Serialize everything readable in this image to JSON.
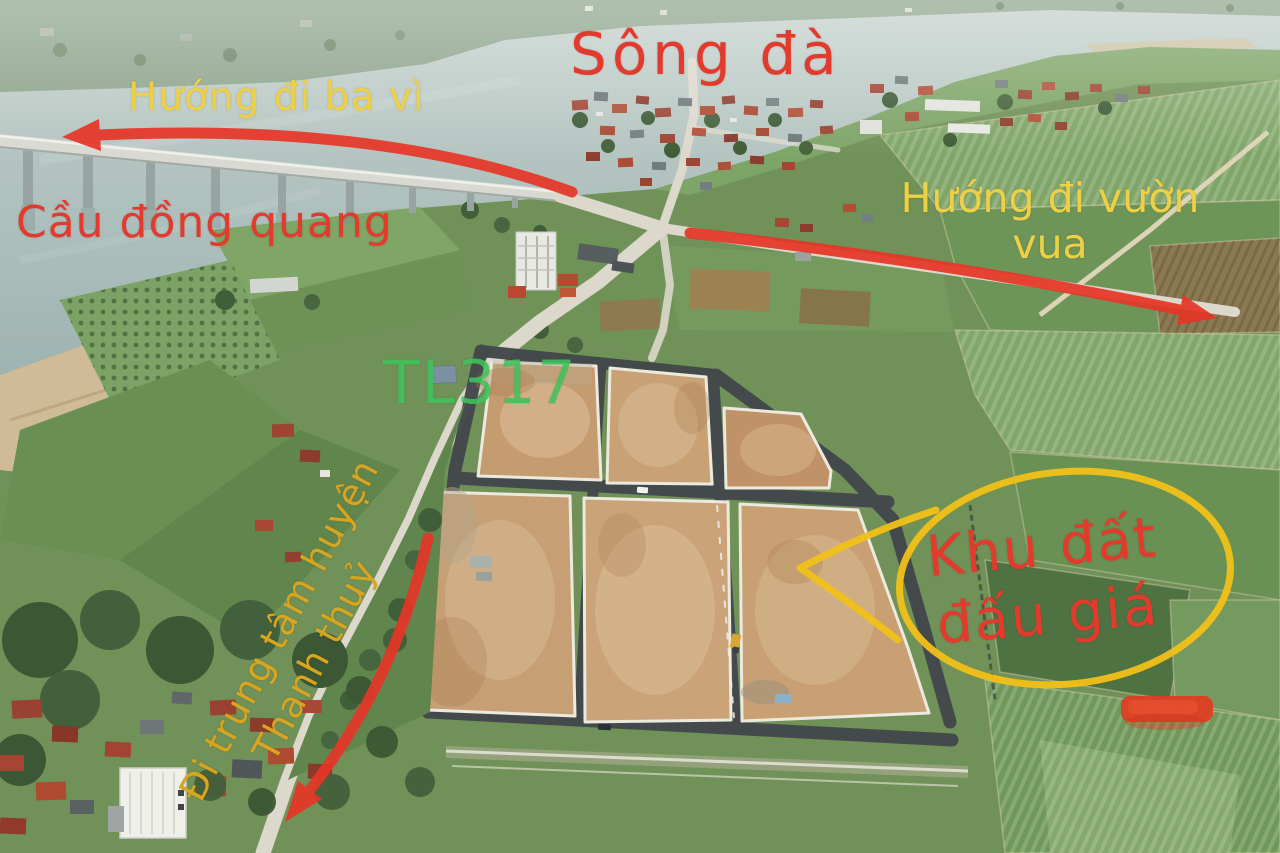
{
  "labels": {
    "river": "Sông đà",
    "direction_ba_vi": "Hướng đi ba vì",
    "bridge": "Cầu đồng quang",
    "direction_vuon_vua": {
      "line1": "Hướng đi vườn",
      "line2": "vua"
    },
    "road": "TL317",
    "auction_area": {
      "line1": "Khu đất",
      "line2": "đấu giá"
    },
    "direction_thanh_thuy": {
      "line1": "Đi trung tâm huyện",
      "line2": "Thanh thuỷ"
    }
  },
  "colors": {
    "red_annotation": "#e23a2c",
    "yellow_annotation": "#edd044",
    "gold_annotation": "#d9a51e",
    "green_annotation": "#3ec35a",
    "ellipse_yellow": "#f2c119",
    "arrow_red": "#e63527"
  }
}
